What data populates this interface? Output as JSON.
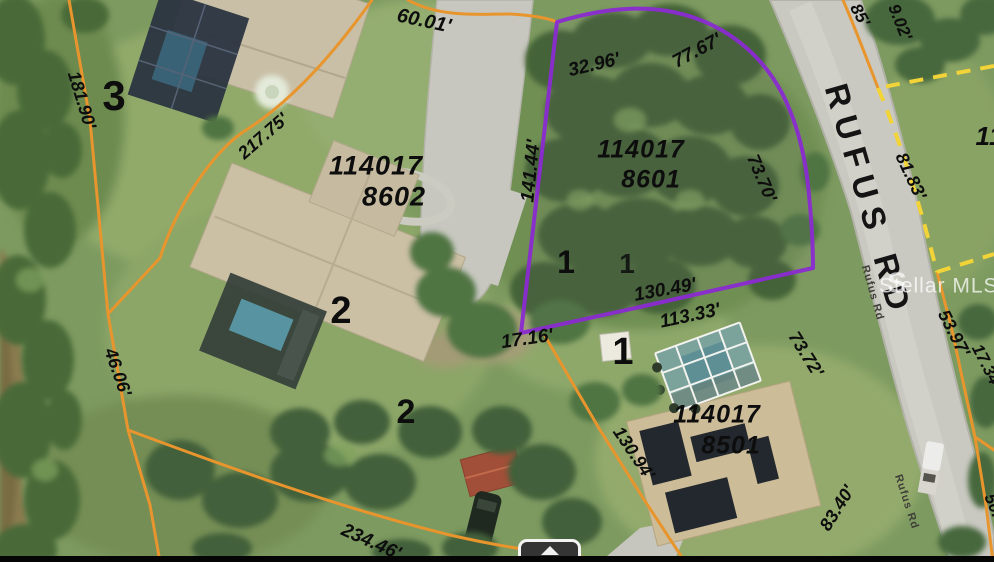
{
  "map": {
    "watermark": {
      "logo_glyph": "S",
      "text": "Stellar MLS®"
    },
    "roads": {
      "main_label": "RUFUS RD",
      "small_label": "Rufus Rd"
    },
    "parcels": {
      "p8602": {
        "apn_line1": "114017",
        "apn_line2": "8602"
      },
      "p8601": {
        "apn_line1": "114017",
        "apn_line2": "8601"
      },
      "p8501": {
        "apn_line1": "114017",
        "apn_line2": "8501"
      },
      "p_right_partial": {
        "apn_partial": "11"
      }
    },
    "area_numbers": {
      "n3": "3",
      "n2a": "2",
      "n2b": "2",
      "n1a": "1",
      "n1b": "1",
      "n1c": "1"
    },
    "dimensions": {
      "d_60_01": "60.01'",
      "d_32_96": "32.96'",
      "d_77_67": "77.67'",
      "d_141_44": "141.44'",
      "d_73_70": "73.70'",
      "d_130_49": "130.49'",
      "d_113_33": "113.33'",
      "d_17_16": "17.16'",
      "d_73_72": "73.72'",
      "d_83_40": "83.40'",
      "d_130_94": "130.94'",
      "d_234_46": "234.46'",
      "d_181_90": "181.90'",
      "d_217_75": "217.75'",
      "d_46_06": "46.06'",
      "d_81_83": "81.83'",
      "d_53_97": "53.97'",
      "d_17_34": "17.34'",
      "d_9_02": "9.02'",
      "d_85": "85'",
      "d_50_09": "50.09'"
    },
    "colors": {
      "highlight_purple": "#8b2bd1",
      "boundary_orange": "#e8952d",
      "boundary_dashed_yellow": "#f2d438"
    },
    "icons": {
      "pan_up": "arrow-up"
    }
  }
}
